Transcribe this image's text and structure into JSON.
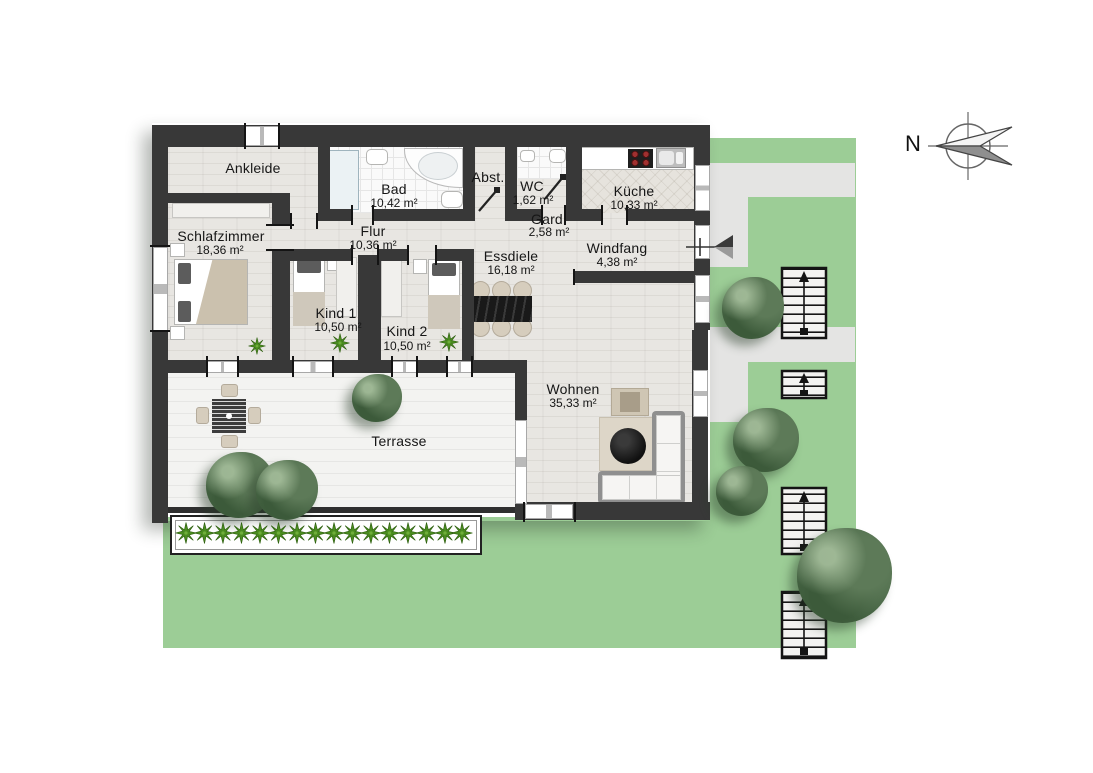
{
  "compass": {
    "label": "N"
  },
  "rooms": [
    {
      "name": "Ankleide",
      "area": ""
    },
    {
      "name": "Bad",
      "area": "10,42 m²"
    },
    {
      "name": "Abst.",
      "area": ""
    },
    {
      "name": "WC",
      "area": "1,62 m²"
    },
    {
      "name": "Küche",
      "area": "10,33 m²"
    },
    {
      "name": "Schlafzimmer",
      "area": "18,36 m²"
    },
    {
      "name": "Flur",
      "area": "10,36 m²"
    },
    {
      "name": "Gard.",
      "area": "2,58 m²"
    },
    {
      "name": "Windfang",
      "area": "4,38 m²"
    },
    {
      "name": "Essdiele",
      "area": "16,18 m²"
    },
    {
      "name": "Kind 1",
      "area": "10,50 m²"
    },
    {
      "name": "Kind 2",
      "area": "10,50 m²"
    },
    {
      "name": "Wohnen",
      "area": "35,33 m²"
    },
    {
      "name": "Terrasse",
      "area": ""
    }
  ],
  "colors": {
    "wall": "#383838",
    "grass": "#9ccd96",
    "path": "#e4e4e3",
    "floor_wood": "#e8e6e2",
    "deck": "#f3f3f1",
    "plant_green": "#4a8c1f",
    "tree_green": "#4f6d4d",
    "stove_burner": "#a03030"
  }
}
